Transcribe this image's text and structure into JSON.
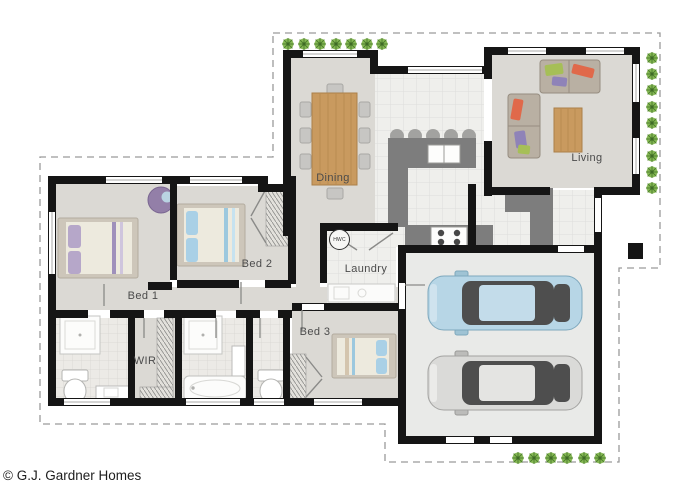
{
  "plan": {
    "rooms": {
      "dining": {
        "label": "Dining"
      },
      "living": {
        "label": "Living"
      },
      "bed1": {
        "label": "Bed 1"
      },
      "bed2": {
        "label": "Bed 2"
      },
      "bed3": {
        "label": "Bed 3"
      },
      "laundry": {
        "label": "Laundry"
      },
      "wir": {
        "label": "WIR"
      }
    },
    "fixtures": {
      "hot_water_cylinder": {
        "label": "HWC"
      },
      "garage_cars": [
        "blue car",
        "silver car"
      ]
    },
    "colors": {
      "wall": "#151515",
      "carpet": "#dbd9d4",
      "tile": "#efefec",
      "bathroom_tile": "#eceae6",
      "garage_floor": "#e9eae8",
      "kitchen_bench": "#7d7d7d",
      "wood": "#c99a5f",
      "plant_green": "#86b954",
      "car_blue": "#b7d6e6",
      "car_silver": "#dadad8",
      "boundary_dash": "#9a9a9a"
    }
  },
  "footer": {
    "copyright": "© G.J. Gardner Homes"
  }
}
